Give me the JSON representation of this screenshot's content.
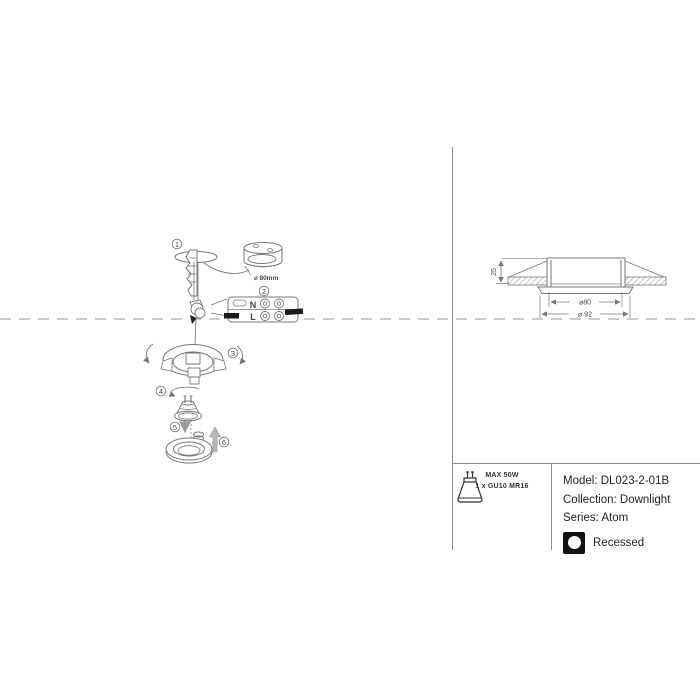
{
  "diagram": {
    "steps": [
      "1",
      "2",
      "3",
      "4",
      "5",
      "6"
    ],
    "hole_saw_label": "⌀ 80mm",
    "terminal_labels": {
      "neutral": "N",
      "live": "L"
    }
  },
  "dimension_drawing": {
    "recess_depth": "25",
    "cutout_diameter": "⌀80",
    "trim_diameter": "⌀ 92"
  },
  "info_panel": {
    "max_power": "MAX 50W",
    "lamp_count_type": "1 x GU10 MR16",
    "model": "Model: DL023-2-01B",
    "collection": "Collection: Downlight",
    "series": "Series: Atom",
    "mounting": "Recessed"
  },
  "colors": {
    "line": "#777777",
    "dash": "#999999",
    "text": "#333333",
    "black": "#111111"
  }
}
